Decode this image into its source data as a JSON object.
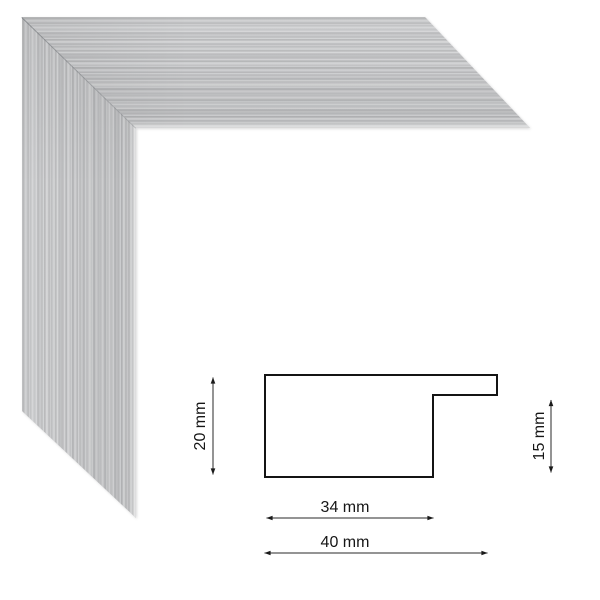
{
  "frame_sample": {
    "description": "brushed-silver picture frame corner sample",
    "base_color": "#c7c8ca"
  },
  "diagram": {
    "line_color": "#1a1a1a",
    "profile_mm": {
      "height": 20,
      "rabbet_side_height": 15,
      "body_width": 34,
      "total_width": 40
    },
    "dim_height_label": "20 mm",
    "dim_rabbet_label": "15 mm",
    "dim_body_width_label": "34 mm",
    "dim_total_width_label": "40 mm"
  }
}
